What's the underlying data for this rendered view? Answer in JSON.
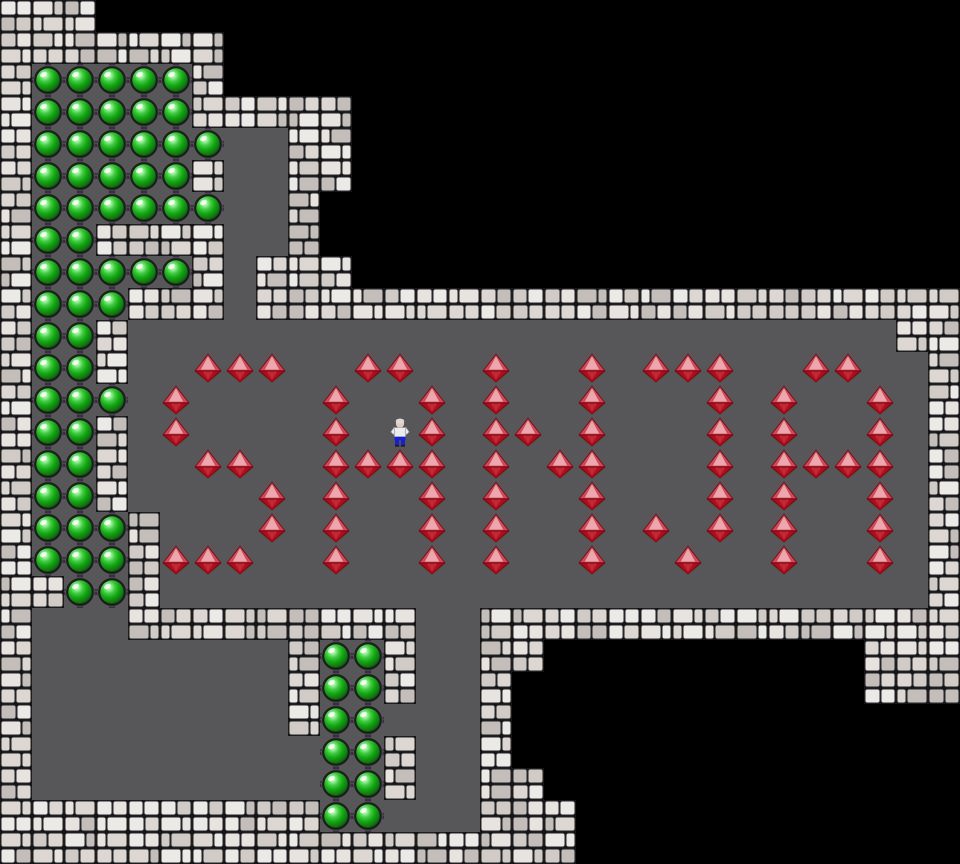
{
  "board": {
    "cols": 30,
    "rows": 27,
    "tile_px": 32,
    "width_px": 960,
    "height_px": 864,
    "word_spelled": "SANJA",
    "goal_ball_count": 70,
    "box_gem_count": 70,
    "player": {
      "col": 12,
      "row": 13
    },
    "letters": [
      {
        "char": "S",
        "col_start": 5,
        "col_end": 8,
        "row_start": 11,
        "row_end": 17
      },
      {
        "char": "A",
        "col_start": 10,
        "col_end": 13,
        "row_start": 11,
        "row_end": 17
      },
      {
        "char": "N",
        "col_start": 15,
        "col_end": 18,
        "row_start": 11,
        "row_end": 17
      },
      {
        "char": "J",
        "col_start": 20,
        "col_end": 22,
        "row_start": 11,
        "row_end": 17
      },
      {
        "char": "A",
        "col_start": 24,
        "col_end": 27,
        "row_start": 11,
        "row_end": 17
      }
    ]
  },
  "legend": {
    "#": "wall",
    ".": "floor",
    "b": "goal-ball",
    "g": "box-gem",
    "p": "player",
    " ": "outside"
  },
  "map": {
    "rows": [
      "###                           ",
      "#######                       ",
      "#bbbbb#                       ",
      "#bbbbb#####                   ",
      "#bbbbbb..##                   ",
      "#bbbbb#..##                   ",
      "#bbbbbb..#                    ",
      "#bb####..#                    ",
      "#bbbbb#.###                   ",
      "#bbb###.######################",
      "#bb#........................##",
      "#bb#..ggg..gg..g..g.ggg..gg..#",
      "#bbb.g....g..g.g..g...g.g..g.#",
      "#bb#.g....g.pg.gg.g...g.g..g.#",
      "#bb#..gg..gggg.g.gg...g.gggg.#",
      "#bb#....g.g..g.g..g...g.g..g.#",
      "#bbb#...g.g..g.g..g.g.g.g..g.#",
      "#bbb#ggg..g..g.g..g..g..g..g.#",
      "##bb#........................#",
      "#...#########..###############",
      "#........#bb#..##          ###",
      "#........#bb#..#           ###",
      "#........#bb...#              ",
      "#.........bb#..#              ",
      "#.........bb#..##             ",
      "##########bb...###            ",
      "##################            "
    ]
  },
  "colors": {
    "outside": "#000000",
    "floor": "#57575a",
    "wall_mortar": "#151515",
    "wall_brick_light": "#e7e3de",
    "wall_brick_mid": "#d0cbc6",
    "wall_brick_dark": "#c3beb9",
    "connector": "#323236",
    "ball_ring": "#1d1d1f",
    "ball_green": "#14a214",
    "ball_highlight": "#dcffd8",
    "gem_edge": "#74070f",
    "gem_upper": "#cf4a56",
    "gem_top_facet": "#eba8b0",
    "gem_lower": "#a90e1b",
    "gem_lower_facet": "#c22733",
    "player_shirt": "#ececef",
    "player_pants": "#1721cf",
    "player_skin": "#e3cdb6",
    "player_hair": "#d9d9d9"
  }
}
